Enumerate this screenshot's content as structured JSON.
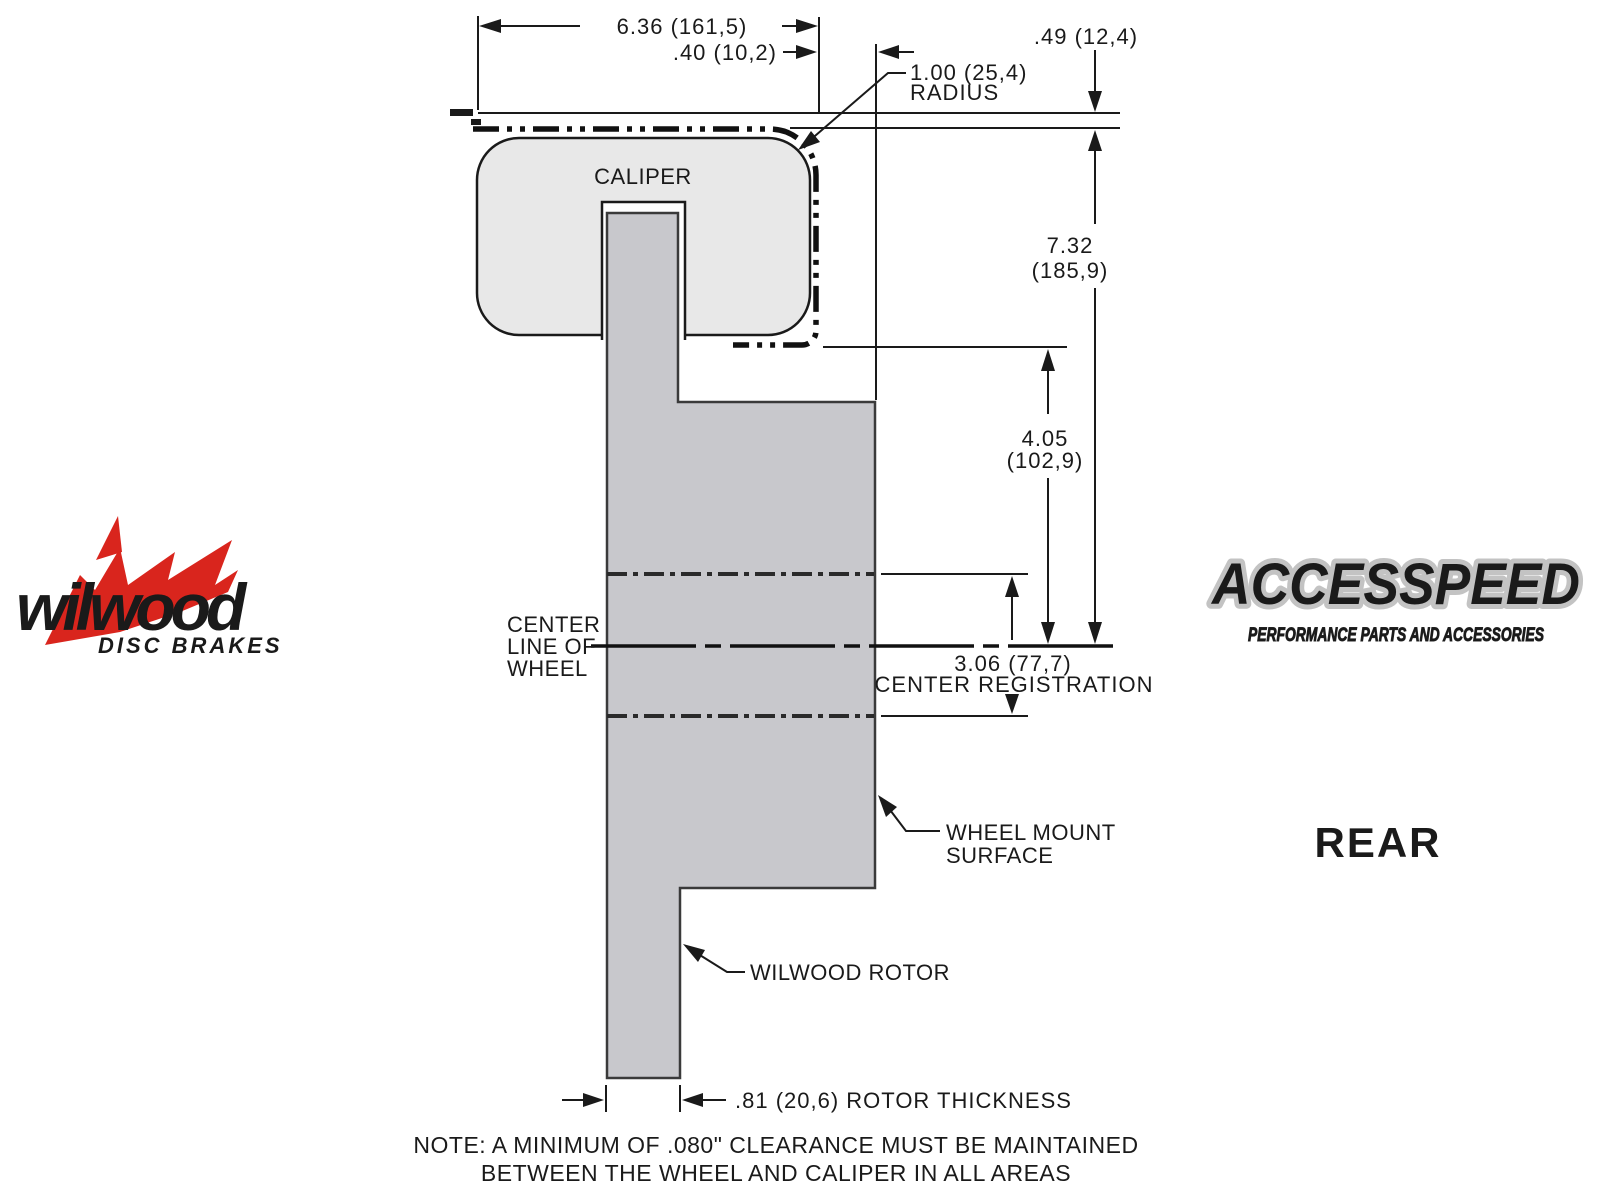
{
  "diagram": {
    "dims": {
      "d636": "6.36 (161,5)",
      "d040": ".40 (10,2)",
      "d049": ".49 (12,4)",
      "d100": "1.00 (25,4)",
      "radius_word": "RADIUS",
      "d732": "7.32",
      "d732mm": "(185,9)",
      "d405": "4.05",
      "d405mm": "(102,9)",
      "d306": "3.06 (77,7)",
      "center_registration": "CENTER REGISTRATION",
      "rotor_thickness": ".81 (20,6) ROTOR THICKNESS"
    },
    "labels": {
      "caliper": "CALIPER",
      "centerline1": "CENTER",
      "centerline2": "LINE OF",
      "centerline3": "WHEEL",
      "wheel_mount1": "WHEEL MOUNT",
      "wheel_mount2": "SURFACE",
      "rotor": "WILWOOD ROTOR",
      "view": "REAR",
      "note1": "NOTE: A MINIMUM OF .080\" CLEARANCE MUST BE MAINTAINED",
      "note2": "BETWEEN THE WHEEL AND CALIPER IN ALL AREAS"
    },
    "colors": {
      "caliper_fill": "#e8e8e8",
      "rotor_fill": "#c8c8cc",
      "line": "#1a1a1a",
      "brand_red": "#d9251d"
    }
  },
  "branding": {
    "wilwood_name": "wilwood",
    "wilwood_tagline": "DISC BRAKES",
    "accesspeed_name": "ACCESSPEED",
    "accesspeed_tagline": "PERFORMANCE PARTS AND ACCESSORIES"
  }
}
